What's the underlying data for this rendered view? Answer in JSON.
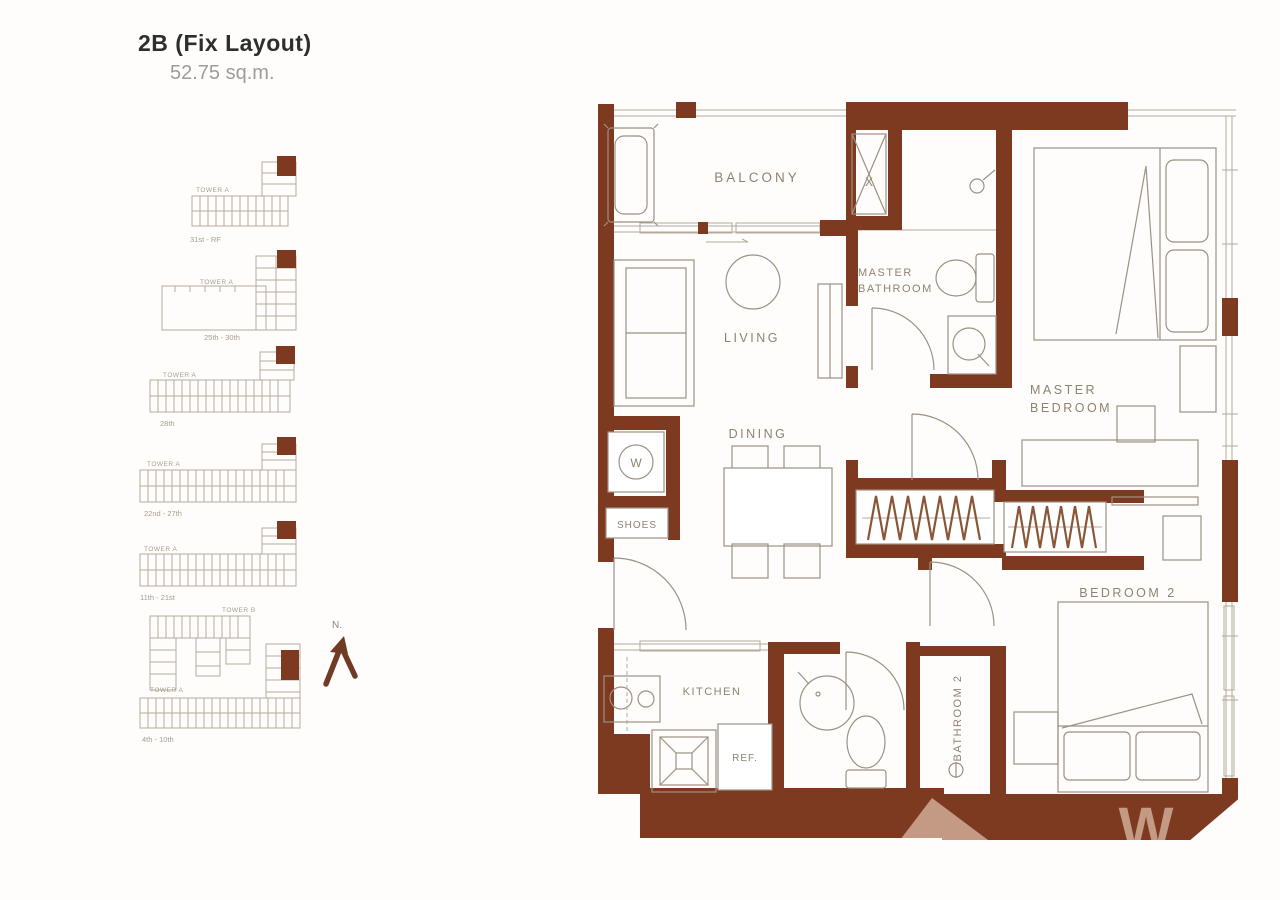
{
  "title": {
    "name": "2B (Fix Layout)",
    "area": "52.75 sq.m."
  },
  "colors": {
    "wall": "#7d3a21",
    "fixture_line": "#9c9184",
    "label_text": "#8e8372",
    "keyplan_line": "#b6ab9c",
    "hanger": "#8a5636",
    "watermark": "#c49a85",
    "north_arrow": "#6f3b24"
  },
  "north_label": "N.",
  "key_plans": [
    {
      "tower": "TOWER A",
      "floors": "31st - RF"
    },
    {
      "tower": "TOWER A",
      "floors": "25th - 30th"
    },
    {
      "tower": "TOWER A",
      "floors": "28th"
    },
    {
      "tower": "TOWER A",
      "floors": "22nd - 27th"
    },
    {
      "tower": "TOWER A",
      "floors": "11th - 21st"
    },
    {
      "tower": "TOWER B"
    },
    {
      "tower": "TOWER A",
      "floors": "4th - 10th"
    }
  ],
  "floor_plan": {
    "balcony": "BALCONY",
    "living": "LIVING",
    "dining": "DINING",
    "master_bathroom": {
      "line1": "MASTER",
      "line2": "BATHROOM"
    },
    "master_bedroom": {
      "line1": "MASTER",
      "line2": "BEDROOM"
    },
    "bedroom2": "BEDROOM 2",
    "bathroom2": "BATHROOM 2",
    "kitchen": "KITCHEN",
    "shoes": "SHOES",
    "ref": "REF.",
    "washer": "W",
    "shaft": "X"
  },
  "watermark": {
    "letter": "W"
  }
}
